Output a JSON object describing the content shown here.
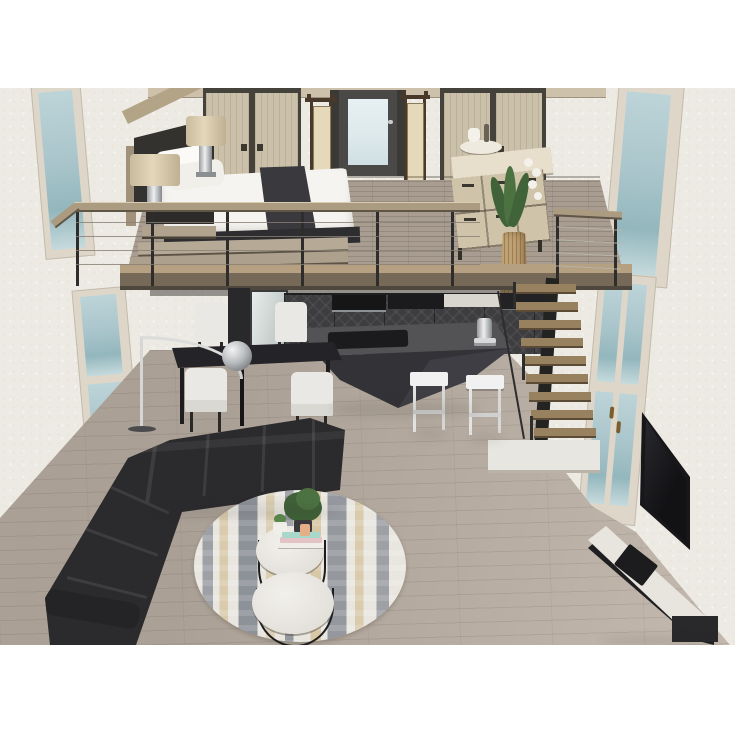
{
  "objects": {
    "scene": "3D loft interior render",
    "back_wall": "textured plaster wall",
    "ceiling_trim": "upper floor ceiling edge",
    "window_upper_left": "tall blue window (upper left)",
    "window_lower_left": "tall blue window (lower left)",
    "window_upper_right": "tall blue window (upper right)",
    "glazed_door_right": "glazed french door (right wall)",
    "wardrobe_left": "light wood double wardrobe",
    "wardrobe_right": "light wood double wardrobe",
    "bedroom_door": "dark door with frosted glass",
    "paper_lamp_left": "tall shoji paper floor lamp",
    "paper_lamp_right": "tall shoji paper floor lamp",
    "mezzanine_floor": "loft mezzanine plank floor",
    "mezzanine_fascia": "mezzanine front edge",
    "loft_railing": "cable railing with wood handrail",
    "double_bed": "double bed with white duvet",
    "bed_runner": "charcoal bed runner",
    "pillows": "white pillows",
    "bed_frame": "wood bed surround",
    "bed_platform": "wood platform steps",
    "nightstand": "dark nightstand",
    "table_lamp_front": "drum-shade table lamp",
    "table_lamp_rear": "drum-shade table lamp",
    "dresser": "cream dresser with drawers",
    "decor_tray": "tea tray decor",
    "orchid_plant": "white orchid plant",
    "floor_vase": "tall ribbed gold vase",
    "staircase": "floating wood staircase",
    "stair_landing": "white stair landing",
    "kitchen_cabinets": "dark chevron kitchen cabinets",
    "microwave": "built-in microwave",
    "cooktop": "black cooktop counter",
    "backsplash": "marble backsplash",
    "mirror_panel": "mirror panel",
    "tall_cabinet": "tall dark cabinet",
    "kitchen_island": "faceted charcoal island bar",
    "island_tray": "black hob tray",
    "espresso_machine": "chrome espresso machine",
    "bar_stool_left": "white bar stool",
    "bar_stool_right": "white bar stool",
    "dining_table": "black dining table",
    "dining_chair_back_left": "white dining chair",
    "dining_chair_back_right": "white dining chair",
    "dining_chair_front_left": "white dining chair",
    "dining_chair_front_right": "white dining chair",
    "arc_floor_lamp": "silver arc floor lamp",
    "sectional_sofa": "black L-shaped sectional sofa",
    "area_rug": "round abstract rug (navy/gold)",
    "coffee_table_large": "round nesting coffee table (large)",
    "coffee_table_small": "round nesting coffee table (small)",
    "potted_plant": "green potted plant",
    "succulent": "small succulent in white pot",
    "book_stack": "stacked books",
    "candle": "peach candle",
    "wall_tv": "wall-mounted flat TV",
    "media_console": "white media console",
    "media_device": "black media device",
    "console_drawer": "black console drawer unit",
    "ground_floor": "greige plank floor"
  },
  "colors": {
    "wall": "#edeae4",
    "window-glass": "#a9c5cb",
    "window-frame": "#ded7c9",
    "floor-main": "#aaa096",
    "floor-light": "#c3b9ae",
    "mezz-floor": "#a89d90",
    "fascia-top": "#b5a182",
    "fascia": "#776957",
    "rail-wood": "#ab9b81",
    "rail-post": "#2f2d2b",
    "cable": "#867f74",
    "ceiling-band": "#cdc1ab",
    "wardrobe-door": "#cbc0a9",
    "wardrobe-trim": "#45423c",
    "door-dark": "#4a4947",
    "door-glass": "#dce8ea",
    "lamp-shade": "#e4d7ba",
    "paper-panel": "#e6d9ba",
    "lamp-wood": "#49392b",
    "bed-white": "#f6f4f0",
    "bed-runner": "#3a393d",
    "bed-base": "#2e2d2f",
    "platform-wood": "#b6aa97",
    "nightstand": "#2c2b2a",
    "dresser-top": "#e7decb",
    "dresser-face": "#cfc3aa",
    "vase-gold": "#c0a173",
    "plant-green": "#41633a",
    "cabinet-dark": "#3d3c3e",
    "cabinet-darker": "#29282a",
    "marble": "#d9d6cf",
    "island-top": "#535255",
    "island-body": "#333237",
    "island-facet": "#3f3e44",
    "hob-black": "#1b1b1d",
    "stool-white": "#f0f1f0",
    "table-black": "#242327",
    "chair-white": "#e9e8e4",
    "sofa-black": "#2b2a2d",
    "sofa-seam": "#3d3c3f",
    "rug-base": "#e9e6df",
    "rug-navy": "#414b5e",
    "rug-gold": "#c2a35f",
    "coffee-top": "#ecc",
    "tv-black": "#17171a",
    "console-white": "#e8e5df",
    "metal-black": "#1f1f21",
    "stairs-wood": "#97815f",
    "stringer": "#232322",
    "landing-white": "#e8e6e0",
    "bronze": "#7a5c2e",
    "mirror": "#ccd4d2",
    "book-pink": "#e3c3c6",
    "book-teal": "#a8d8cb",
    "candle-peach": "#e4ae86",
    "sphere-silver": "#b9bcbe"
  }
}
